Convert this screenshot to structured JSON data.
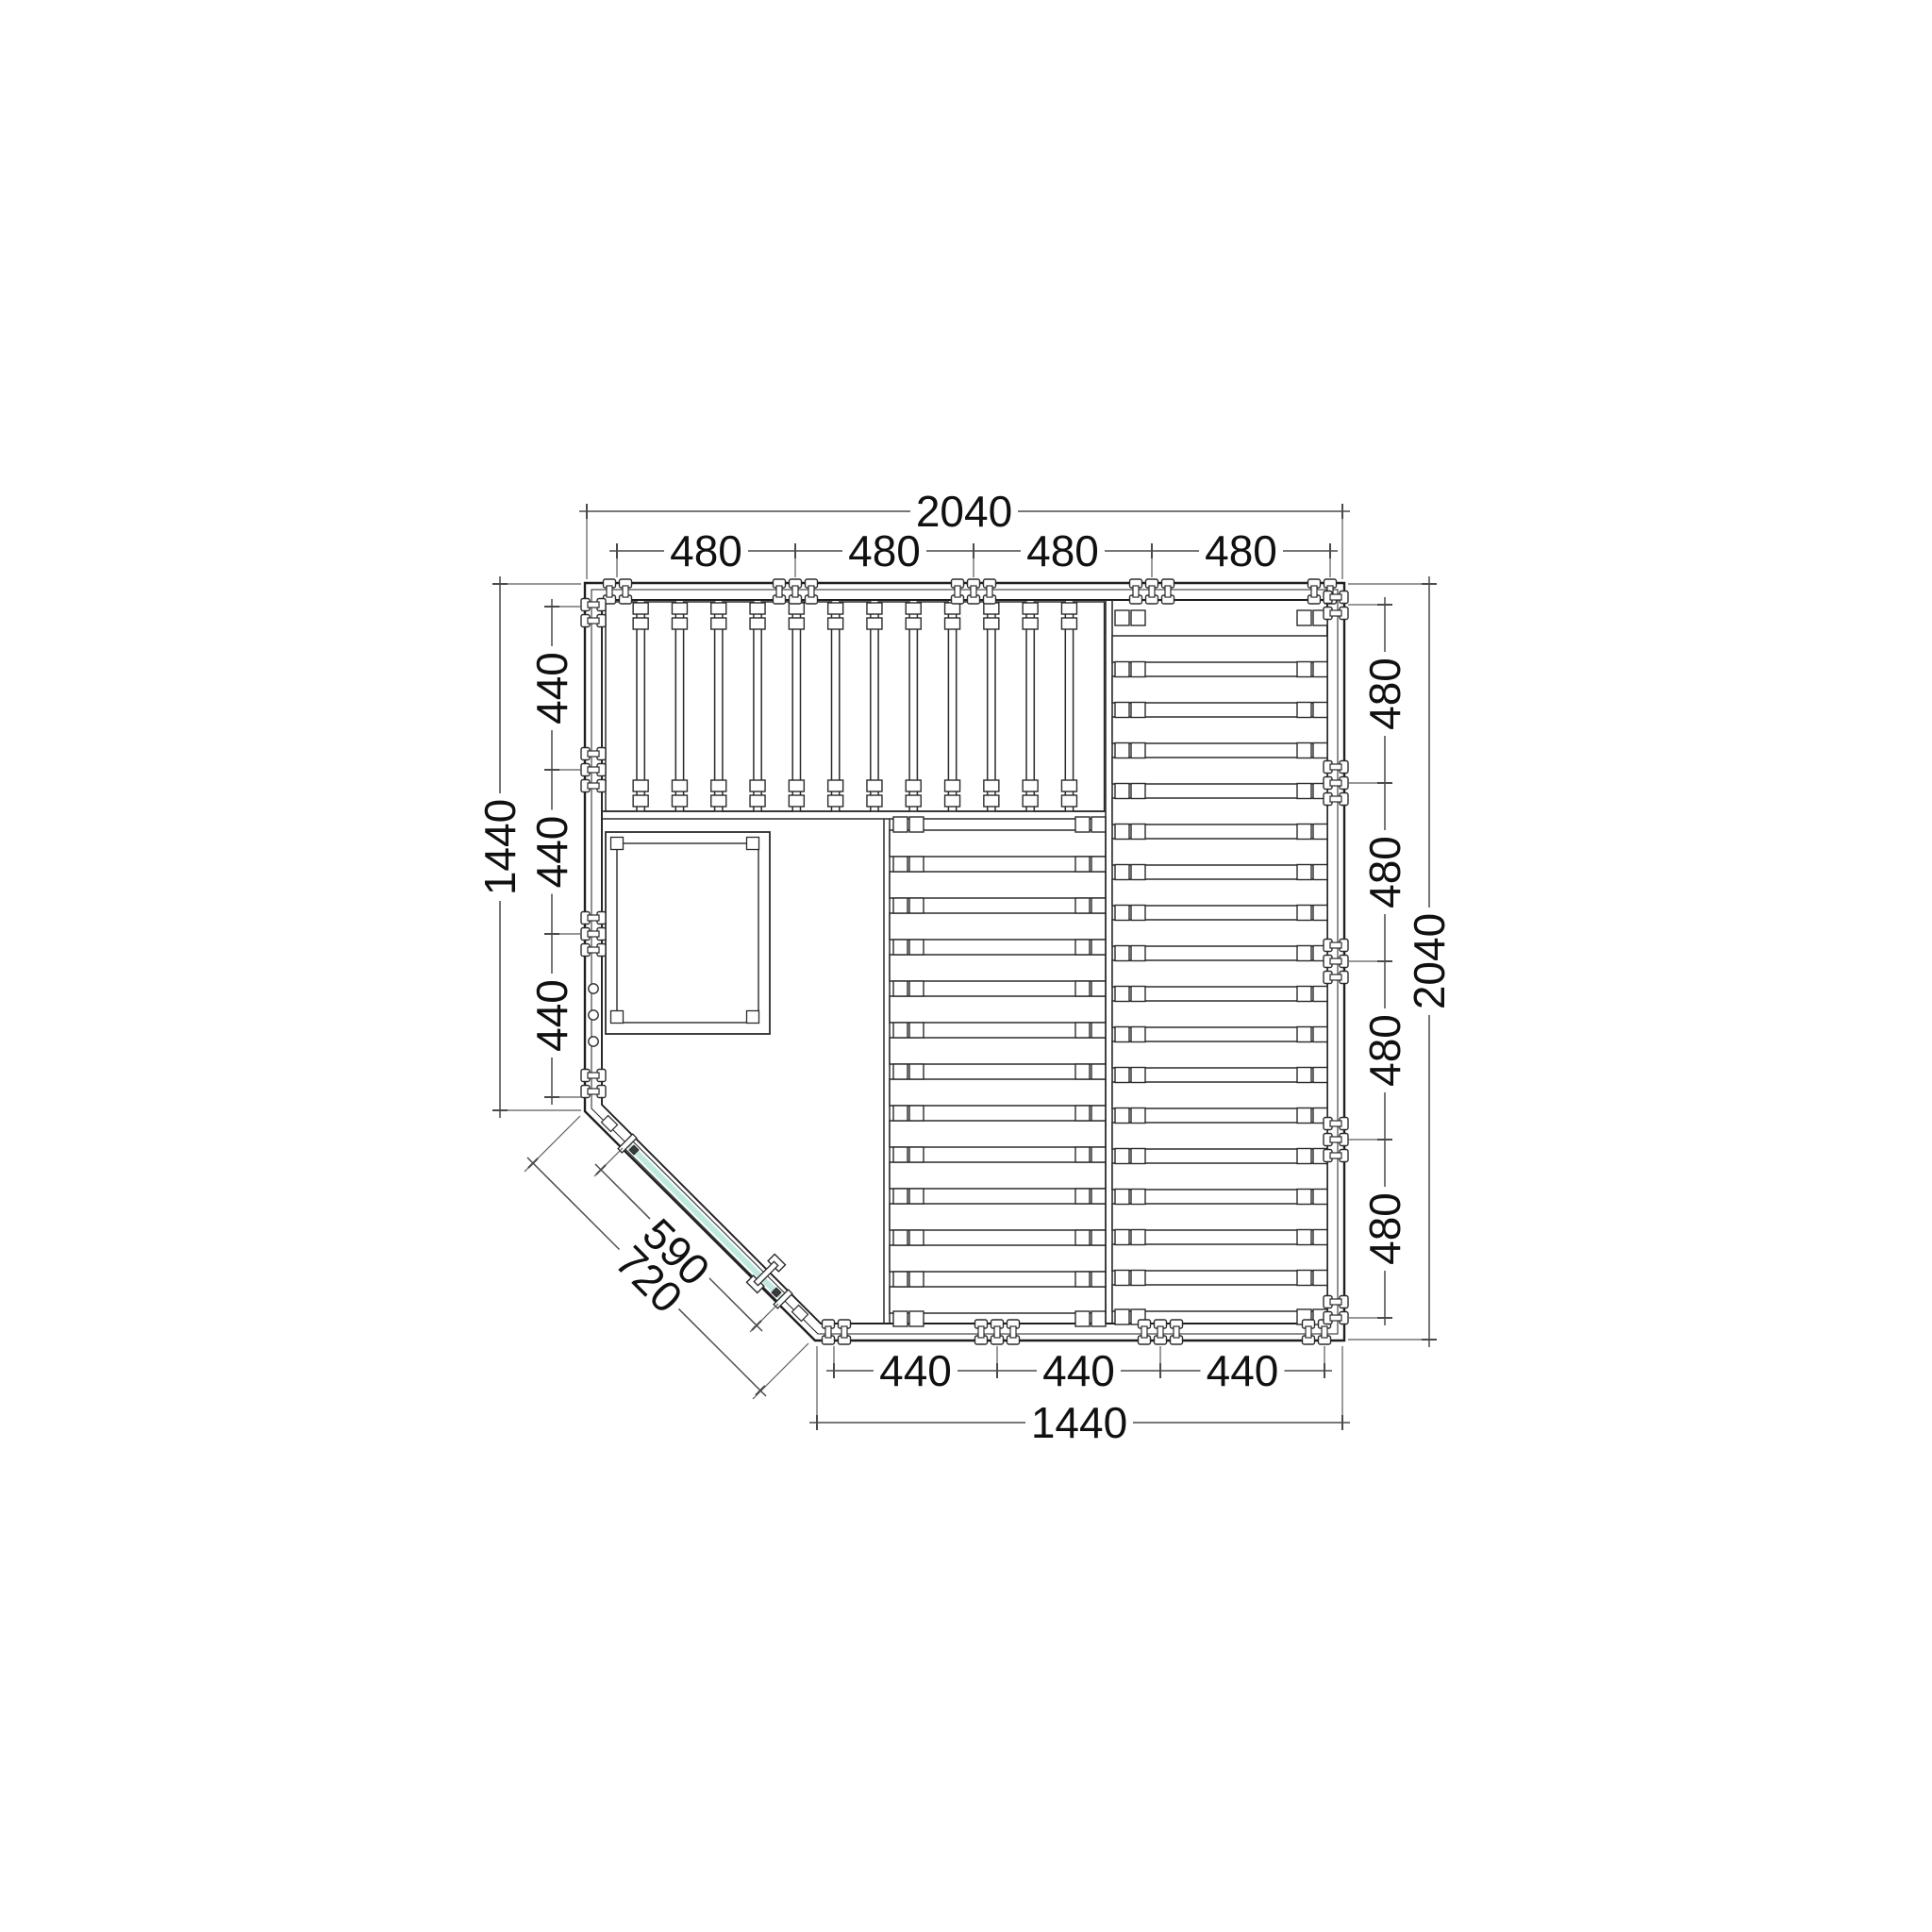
{
  "drawing": {
    "type": "technical-floor-plan",
    "subject": "corner sauna cabin frame layout, top view",
    "units": "mm"
  },
  "colors": {
    "background": "#ffffff",
    "wall_line": "#1f1f1f",
    "part_line": "#2b2b2b",
    "dim_line": "#4a4a4a",
    "ext_line": "#5a5a5a",
    "text": "#101010",
    "glass": "#bfe8e0"
  },
  "dimensions": {
    "top": {
      "overall": "2040",
      "segments": [
        "480",
        "480",
        "480",
        "480"
      ]
    },
    "bottom": {
      "overall": "1440",
      "segments": [
        "440",
        "440",
        "440"
      ]
    },
    "left": {
      "overall": "1440",
      "segments": [
        "440",
        "440",
        "440"
      ]
    },
    "right": {
      "overall": "2040",
      "segments": [
        "480",
        "480",
        "480",
        "480"
      ]
    },
    "diagonal": {
      "inner": "590",
      "outer": "720"
    }
  },
  "components": {
    "benches": {
      "top_bench_board_count": 13,
      "middle_bench_board_count": 12,
      "right_bench_board_count": 17
    },
    "heater_platform": {
      "present": true
    },
    "door": {
      "kind": "glass-door",
      "location": "diagonal-corner"
    },
    "wall_connectors": {
      "icon": "clamp-icon"
    },
    "vent_holes": {
      "count": 3,
      "icon": "circle-hole-icon"
    }
  }
}
